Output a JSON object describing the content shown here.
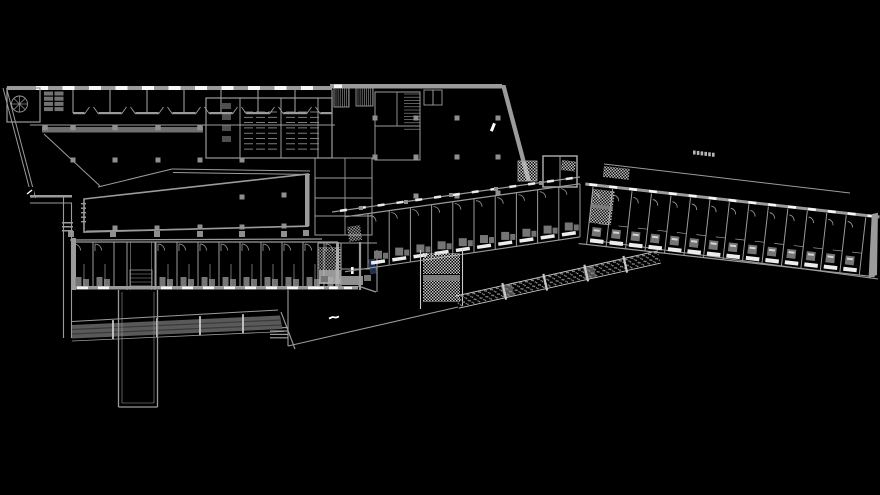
{
  "canvas": {
    "w": 880,
    "h": 495,
    "bg": "#000000"
  },
  "palette": {
    "bg": "#000000",
    "wall": "#9b9b9b",
    "wall_light": "#c9c9c9",
    "wall_dim": "#6f6f6f",
    "ink_white": "#ffffff",
    "slab": "#ececec",
    "fixture": "#757575",
    "ramp_fill": "#595959",
    "ramp_lane": "#3a3a3a",
    "corridor_fill": "#b3b3b3",
    "column": "#8f8f8f",
    "accent_navy": "#1f2e50"
  },
  "structures": {
    "top_wing": {
      "rooms": 7,
      "room_w": 37,
      "x0": 73,
      "room_top": 90,
      "room_bot": 113,
      "windows": {
        "x0": 36,
        "step": 26.5,
        "w": 12,
        "count": 11,
        "y": 86,
        "h": 4
      }
    },
    "toilets": {
      "clusters": [
        244,
        256,
        268,
        286,
        298,
        310
      ],
      "rows": 8,
      "y0": 112,
      "dy": 5.3,
      "len": 9
    },
    "left_wing": {
      "dividers": [
        72,
        93,
        114,
        156,
        177,
        198,
        219,
        240,
        261,
        282,
        303,
        324,
        338
      ],
      "gap": [
        114,
        156
      ],
      "top": 242,
      "bottom": 288
    },
    "mid_wing": {
      "count": 10,
      "x0": 368,
      "step": 21.2,
      "top": {
        "x": 345,
        "y": 216.8,
        "m": -0.1405
      },
      "bot": {
        "x": 345,
        "y": 271.7,
        "m": -0.148
      }
    },
    "right_wing": {
      "count": 14,
      "x0": 8,
      "step": 19.6,
      "tx": 586,
      "ty": 178,
      "rot": 6.4,
      "len": 296,
      "room_top": 12,
      "room_bot": 66
    },
    "columns": {
      "hall": [
        [
          375,
          118
        ],
        [
          416,
          118
        ],
        [
          457,
          118
        ],
        [
          498,
          118
        ],
        [
          375,
          157
        ],
        [
          416,
          157
        ],
        [
          457,
          157
        ],
        [
          498,
          157
        ],
        [
          416,
          196
        ],
        [
          457,
          196
        ],
        [
          498,
          193
        ]
      ],
      "wedge": [
        [
          73,
          160
        ],
        [
          115,
          160
        ],
        [
          158,
          160
        ],
        [
          200,
          160
        ],
        [
          242,
          160
        ],
        [
          242,
          197
        ],
        [
          284,
          195
        ],
        [
          115,
          228
        ],
        [
          157,
          228
        ],
        [
          200,
          227
        ],
        [
          242,
          227
        ],
        [
          284,
          226
        ]
      ],
      "street": [
        [
          71,
          234
        ],
        [
          113,
          234
        ],
        [
          157,
          234
        ],
        [
          200,
          234
        ],
        [
          242,
          234
        ],
        [
          284,
          234
        ],
        [
          306,
          233
        ]
      ],
      "bar": [
        [
          45,
          127.5
        ],
        [
          73,
          127.5
        ],
        [
          115,
          127.5
        ],
        [
          158,
          127.5
        ],
        [
          200,
          127.5
        ]
      ],
      "street_dots": [
        [
          361,
          208
        ],
        [
          406,
          202
        ],
        [
          451,
          195
        ],
        [
          496,
          189
        ],
        [
          541,
          183
        ]
      ]
    },
    "ramp": {
      "ticks": [
        113,
        157,
        200,
        243
      ]
    },
    "canopy_squares": {
      "x0": 693,
      "y0": 150.5,
      "step": 3.8,
      "drop": 0.45,
      "count": 6,
      "w": 2.6,
      "h": 4
    }
  }
}
